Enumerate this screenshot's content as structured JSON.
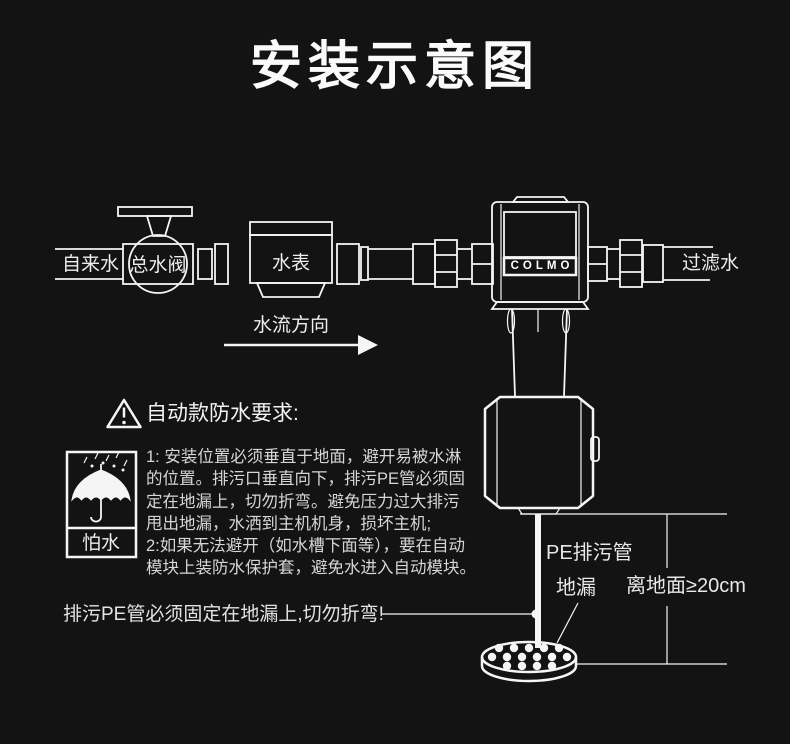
{
  "title": "安装示意图",
  "colors": {
    "background": "#131313",
    "line": "#f5f5f5",
    "text": "#ededed"
  },
  "icons": {
    "warning": "warning-triangle-icon",
    "keep_dry": "keep-dry-umbrella-icon"
  },
  "pipeline": {
    "tap_water": "自来水",
    "main_valve": "总水阀",
    "water_meter": "水表",
    "device_brand": "COLMO",
    "filtered_water": "过滤水",
    "flow_direction": "水流方向"
  },
  "warning": {
    "title": "自动款防水要求:",
    "keep_dry_label": "怕水",
    "instructions": "1: 安装位置必须垂直于地面，避开易被水淋\n的位置。排污口垂直向下，排污PE管必须固\n定在地漏上，切勿折弯。避免压力过大排污\n甩出地漏，水洒到主机机身，损坏主机;\n2:如果无法避开（如水槽下面等），要在自动\n模块上装防水保护套，避免水进入自动模块。"
  },
  "callouts": {
    "fix_note": "排污PE管必须固定在地漏上,切勿折弯!",
    "pe_pipe": "PE排污管",
    "floor_drain": "地漏",
    "height_requirement": "离地面≥20cm"
  }
}
